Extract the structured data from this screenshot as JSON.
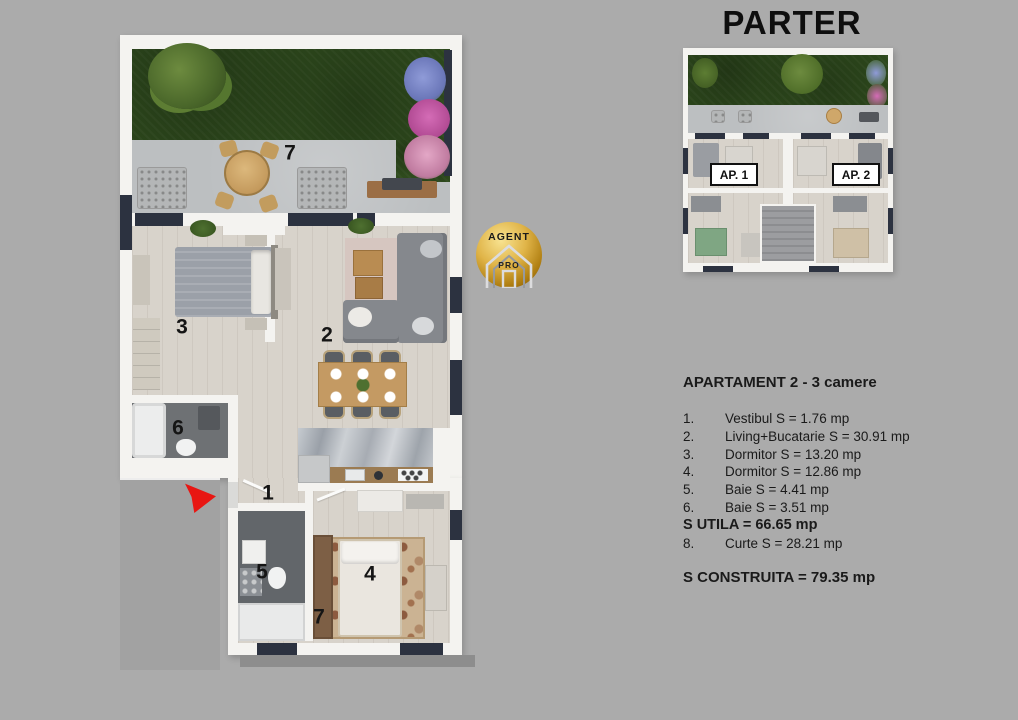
{
  "title": "PARTER",
  "logo": {
    "top_text": "AGENT",
    "bottom_text": "PRO"
  },
  "mini_plan": {
    "ap1_label": "AP. 1",
    "ap2_label": "AP. 2"
  },
  "main_plan": {
    "labels": {
      "terrace": "7",
      "bedroom3": "3",
      "living": "2",
      "bath6": "6",
      "vestibul": "1",
      "bath5": "5",
      "bedroom4": "4",
      "lower7": "7"
    }
  },
  "details": {
    "title": "APARTAMENT 2 - 3 camere",
    "rows": [
      {
        "num": "1.",
        "text": "Vestibul S = 1.76 mp"
      },
      {
        "num": "2.",
        "text": "Living+Bucatarie S = 30.91 mp"
      },
      {
        "num": "3.",
        "text": "Dormitor S = 13.20 mp"
      },
      {
        "num": "4.",
        "text": "Dormitor S = 12.86 mp"
      },
      {
        "num": "5.",
        "text": "Baie S = 4.41 mp"
      },
      {
        "num": "6.",
        "text": "Baie S = 3.51 mp"
      },
      {
        "num": "",
        "text": "S UTILA = 66.65 mp"
      },
      {
        "num": "8.",
        "text": "Curte S = 28.21 mp"
      }
    ],
    "footer": "S CONSTRUITA = 79.35 mp"
  },
  "colors": {
    "background": "#ababab",
    "wall": "#f4f3f0",
    "window": "#2c3240",
    "grass": "#2e4a1d",
    "arrow_red": "#e81612",
    "logo_gold": "#d4a017"
  }
}
